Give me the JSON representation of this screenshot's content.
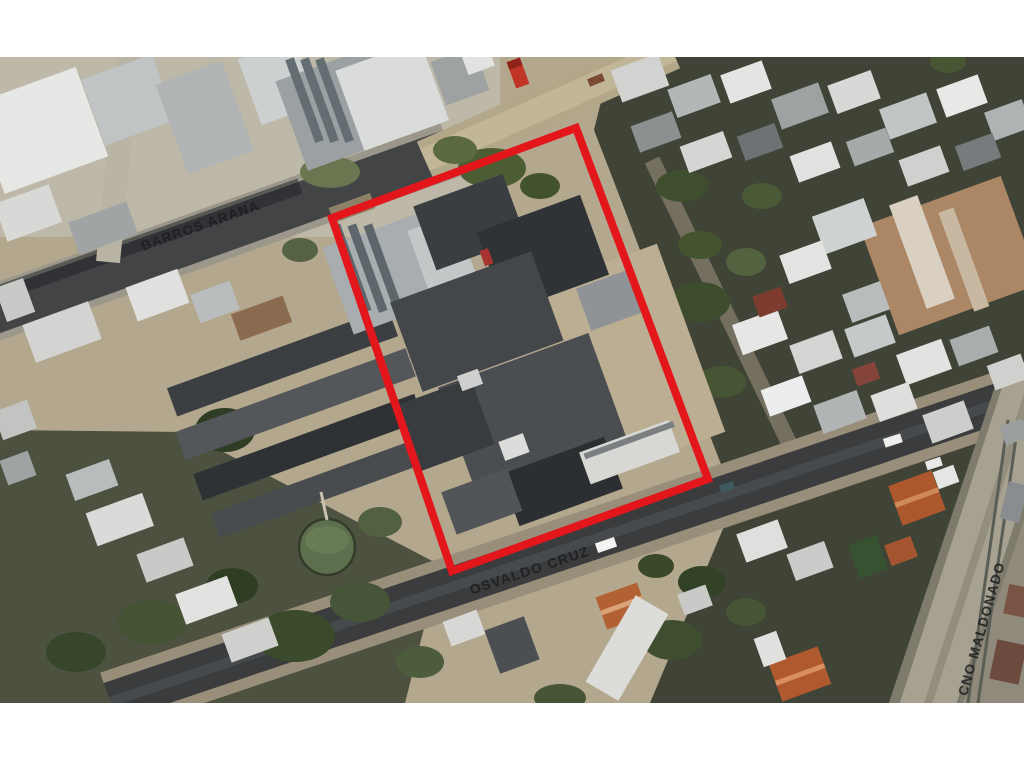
{
  "canvas": {
    "background": "#ffffff"
  },
  "map": {
    "kind": "satellite-aerial-photo",
    "subject": "industrial property block outlined in red",
    "boundary": {
      "color": "#e3161c",
      "stroke_width": "8",
      "points": "332,218 576,128 708,479 452,571"
    },
    "street_label_color": "#1d1e20",
    "streets": [
      {
        "id": "barros-arana",
        "label": "BARROS ARANA"
      },
      {
        "id": "osvaldo-cruz",
        "label": "OSVALDO CRUZ"
      },
      {
        "id": "cno-maldonado",
        "label": "CNO MALDONADO"
      }
    ]
  }
}
